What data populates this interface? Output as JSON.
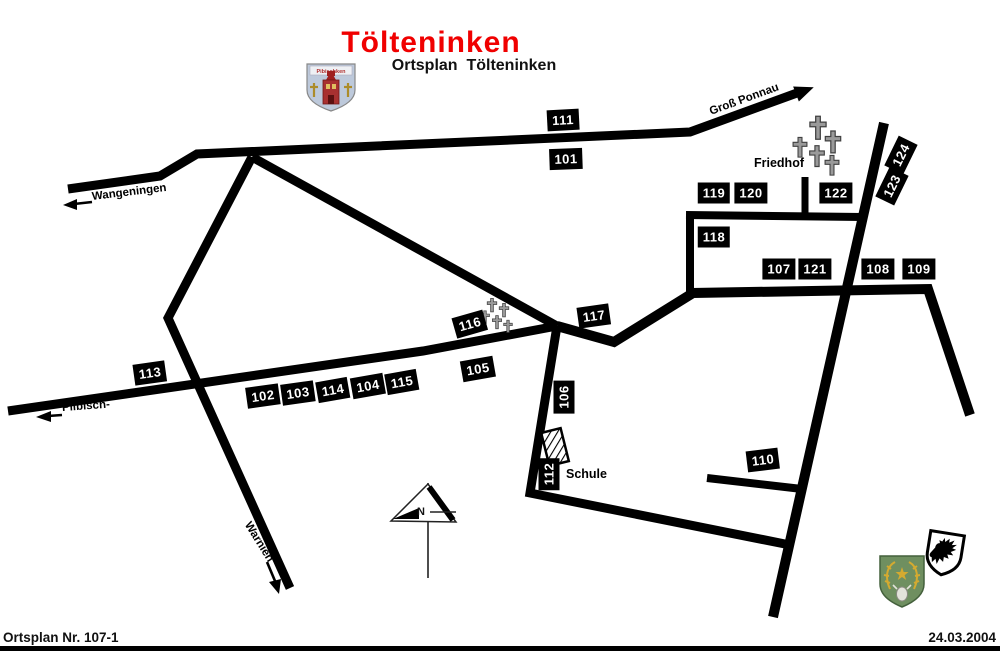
{
  "title": "Tölteninken",
  "subtitle": "Ortsplan  Tölteninken",
  "footer": {
    "left": "Ortsplan Nr. 107-1",
    "right": "24.03.2004"
  },
  "colors": {
    "road": "#000000",
    "title": "#f00000",
    "label_bg": "#000000",
    "label_fg": "#ffffff"
  },
  "crests": {
    "top_village_name": "Pibischken"
  },
  "map": {
    "compass_label": "N",
    "places": {
      "friedhof": {
        "text": "Friedhof",
        "x": 754,
        "y": 156
      },
      "schule": {
        "text": "Schule",
        "x": 566,
        "y": 467
      }
    },
    "road_names": [
      {
        "text": "Groß Ponnau",
        "x": 710,
        "y": 112,
        "rot": -20
      },
      {
        "text": "Wangeningen",
        "x": 92,
        "y": 197,
        "rot": -7
      },
      {
        "text": "Pilbisch-",
        "x": 62,
        "y": 408,
        "rot": -4
      },
      {
        "text": "Warnien",
        "x": 247,
        "y": 523,
        "rot": 58
      }
    ],
    "number_labels": [
      {
        "text": "101",
        "x": 566,
        "y": 159,
        "rot": -2
      },
      {
        "text": "111",
        "x": 563,
        "y": 120,
        "rot": -3
      },
      {
        "text": "102",
        "x": 263,
        "y": 396,
        "rot": -8
      },
      {
        "text": "103",
        "x": 298,
        "y": 393,
        "rot": -8
      },
      {
        "text": "114",
        "x": 333,
        "y": 390,
        "rot": -10
      },
      {
        "text": "104",
        "x": 368,
        "y": 386,
        "rot": -10
      },
      {
        "text": "115",
        "x": 402,
        "y": 382,
        "rot": -10
      },
      {
        "text": "105",
        "x": 478,
        "y": 369,
        "rot": -10
      },
      {
        "text": "113",
        "x": 150,
        "y": 373,
        "rot": -8
      },
      {
        "text": "116",
        "x": 470,
        "y": 324,
        "rot": -16
      },
      {
        "text": "117",
        "x": 594,
        "y": 316,
        "rot": -8
      },
      {
        "text": "106",
        "x": 564,
        "y": 397,
        "rot": -90
      },
      {
        "text": "112",
        "x": 549,
        "y": 474,
        "rot": -90
      },
      {
        "text": "110",
        "x": 763,
        "y": 460,
        "rot": -7
      },
      {
        "text": "107",
        "x": 779,
        "y": 269,
        "rot": 0
      },
      {
        "text": "121",
        "x": 815,
        "y": 269,
        "rot": 0
      },
      {
        "text": "108",
        "x": 878,
        "y": 269,
        "rot": 0
      },
      {
        "text": "109",
        "x": 919,
        "y": 269,
        "rot": 0
      },
      {
        "text": "118",
        "x": 714,
        "y": 237,
        "rot": 0
      },
      {
        "text": "119",
        "x": 714,
        "y": 193,
        "rot": 0
      },
      {
        "text": "120",
        "x": 751,
        "y": 193,
        "rot": 0
      },
      {
        "text": "122",
        "x": 836,
        "y": 193,
        "rot": 0
      },
      {
        "text": "123",
        "x": 892,
        "y": 186,
        "rot": -64
      },
      {
        "text": "124",
        "x": 901,
        "y": 155,
        "rot": -64
      }
    ]
  }
}
